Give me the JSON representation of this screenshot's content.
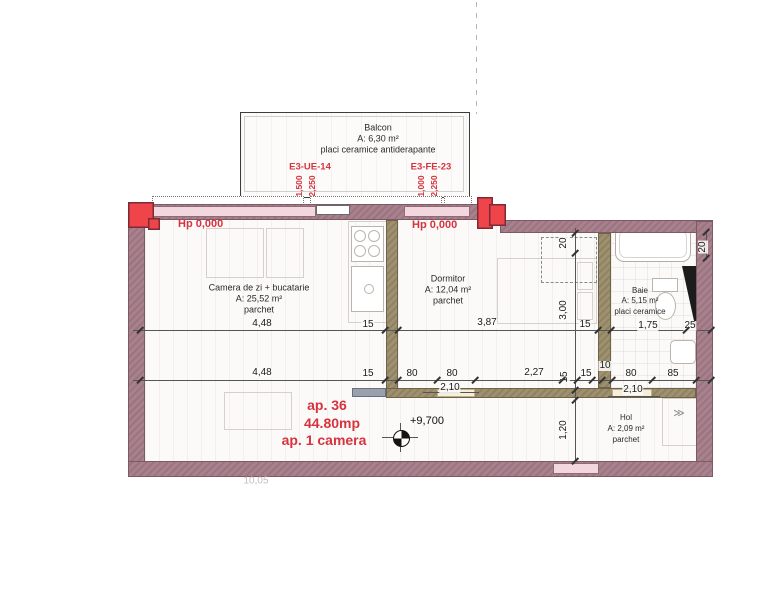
{
  "apartment": {
    "number": "ap. 36",
    "area": "44.80mp",
    "type": "ap. 1 camera"
  },
  "level_mark": "+9,700",
  "hp_left": "Hp 0,000",
  "hp_right": "Hp 0,000",
  "rooms": {
    "balcon": {
      "name": "Balcon",
      "area": "A: 6,30 m²",
      "finish": "placi ceramice antiderapante"
    },
    "living": {
      "name": "Camera de zi + bucatarie",
      "area": "A: 25,52 m²",
      "finish": "parchet"
    },
    "dormitor": {
      "name": "Dormitor",
      "area": "A: 12,04 m²",
      "finish": "parchet"
    },
    "baie": {
      "name": "Baie",
      "area": "A: 5,15 m²",
      "finish": "placi ceramice"
    },
    "hol": {
      "name": "Hol",
      "area": "A: 2,09 m²",
      "finish": "parchet"
    }
  },
  "window_labels": {
    "w1": {
      "code": "E3-UE-14",
      "width": "1,500",
      "height": "2,250"
    },
    "w2": {
      "code": "E3-FE-23",
      "width": "1,000",
      "height": "2,250"
    }
  },
  "dims": {
    "a1": "4,48",
    "a2": "15",
    "a3": "3,87",
    "a4": "15",
    "a5": "1,75",
    "a6": "25",
    "b1": "4,48",
    "b2": "15",
    "b3": "80",
    "b4": "80",
    "b5": "2,27",
    "b6": "15",
    "b7": "15",
    "b8": "10",
    "b9": "80",
    "b10": "85",
    "door1": "2,10",
    "door2": "2,10",
    "v1": "20",
    "v2": "3,00",
    "v3": "1,20",
    "v4": "20"
  },
  "faint_note": "10,05",
  "icons": {
    "door_swing": "≫",
    "level_marker": "survey-level-symbol"
  },
  "colors": {
    "outer_wall": "#a8818d",
    "inner_wall": "#9b8e6e",
    "marker_red": "#ef4449",
    "annotation_red": "#d6333f",
    "window_pink": "#f2d7de",
    "door_cream": "#f5eedb"
  }
}
